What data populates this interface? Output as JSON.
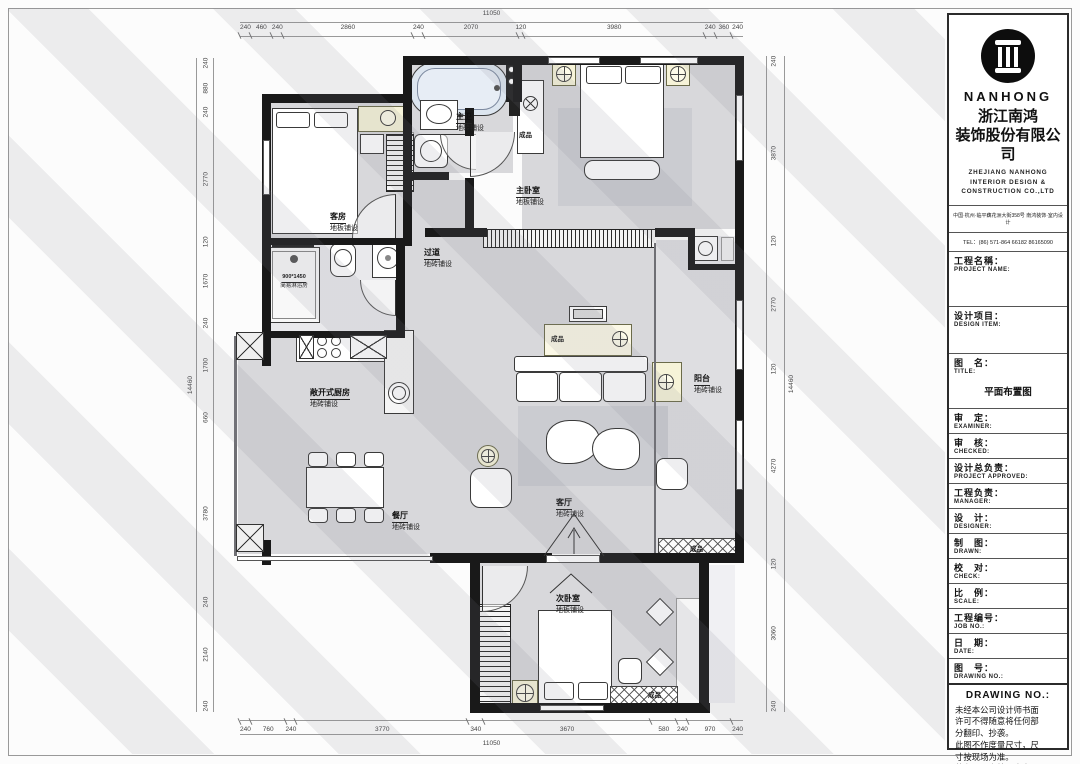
{
  "company": {
    "brand": "NANHONG",
    "name_cn_1": "浙江南鸿",
    "name_cn_2": "装饰股份有限公司",
    "name_en_1": "ZHEJIANG NANHONG",
    "name_en_2": "INTERIOR DESIGN &",
    "name_en_3": "CONSTRUCTION CO.,LTD",
    "address": "中国·杭州·临平藕花洲大街358号 南鸿装饰·室内设计",
    "tel": "TEL：(86) 571-864 66182  86165090"
  },
  "titleblock": {
    "rows": [
      {
        "cn": "工程名稱：",
        "en": "PROJECT NAME:",
        "value": ""
      },
      {
        "cn": "设计项目：",
        "en": "DESIGN ITEM:",
        "value": ""
      },
      {
        "cn": "图　名：",
        "en": "TITLE:",
        "value": "平面布置图"
      },
      {
        "cn": "审　定：",
        "en": "EXAMINER:",
        "value": ""
      },
      {
        "cn": "审　核：",
        "en": "CHECKED:",
        "value": ""
      },
      {
        "cn": "设计总负责：",
        "en": "PROJECT APPROVED:",
        "value": ""
      },
      {
        "cn": "工程负责：",
        "en": "MANAGER:",
        "value": ""
      },
      {
        "cn": "设　计：",
        "en": "DESIGNER:",
        "value": ""
      },
      {
        "cn": "制　图：",
        "en": "DRAWN:",
        "value": ""
      },
      {
        "cn": "校　对：",
        "en": "CHECK:",
        "value": ""
      },
      {
        "cn": "比　例：",
        "en": "SCALE:",
        "value": ""
      },
      {
        "cn": "工程编号：",
        "en": "JOB NO.:",
        "value": ""
      },
      {
        "cn": "日　期：",
        "en": "DATE:",
        "value": ""
      },
      {
        "cn": "图　号：",
        "en": "DRAWING NO.:",
        "value": ""
      }
    ],
    "notice_title": "DRAWING NO.:",
    "notice_lines": [
      "未经本公司设计师书面",
      "许可不得随意将任何部",
      "分翻印、抄袭。",
      "此图不作度量尺寸，尺",
      "寸按现场为准。",
      "若有不明之处，应立即",
      "通知设计师。"
    ]
  },
  "dims": {
    "top_total": "11050",
    "top": [
      "240",
      "460",
      "240",
      "2860",
      "240",
      "2070",
      "120",
      "3980",
      "240",
      "360",
      "240"
    ],
    "bottom": [
      "240",
      "760",
      "240",
      "3770",
      "340",
      "3670",
      "580",
      "240",
      "970",
      "240"
    ],
    "bottom_total": "11050",
    "left_total": "14460",
    "left": [
      "240",
      "880",
      "240",
      "2770",
      "120",
      "1670",
      "240",
      "1700",
      "660",
      "3780",
      "240",
      "2140",
      "240"
    ],
    "right": [
      "240",
      "3870",
      "120",
      "2770",
      "120",
      "4270",
      "120",
      "3060",
      "240"
    ],
    "right_total": "14460"
  },
  "rooms": {
    "guest": {
      "name": "客房",
      "floor": "地板铺设"
    },
    "master_bath": {
      "name": "主卫",
      "floor": "地砖铺设"
    },
    "master": {
      "name": "主卧室",
      "floor": "地板铺设"
    },
    "hallway": {
      "name": "过道",
      "floor": "地砖铺设"
    },
    "shower": {
      "name": "900*1450",
      "floor": "简易淋浴房"
    },
    "kitchen": {
      "name": "敞开式厨房",
      "floor": "地砖铺设"
    },
    "dining": {
      "name": "餐厅",
      "floor": "地砖铺设"
    },
    "living": {
      "name": "客厅",
      "floor": "地砖铺设"
    },
    "balcony": {
      "name": "阳台",
      "floor": "地砖铺设"
    },
    "second": {
      "name": "次卧室",
      "floor": "地板铺设"
    }
  },
  "labels": {
    "finished": "成品"
  },
  "colors": {
    "wall": "#191919",
    "floor": "#d8d8db",
    "cream": "#f6f3d8",
    "tub": "#dce5ef",
    "accent_line": "#999999"
  }
}
